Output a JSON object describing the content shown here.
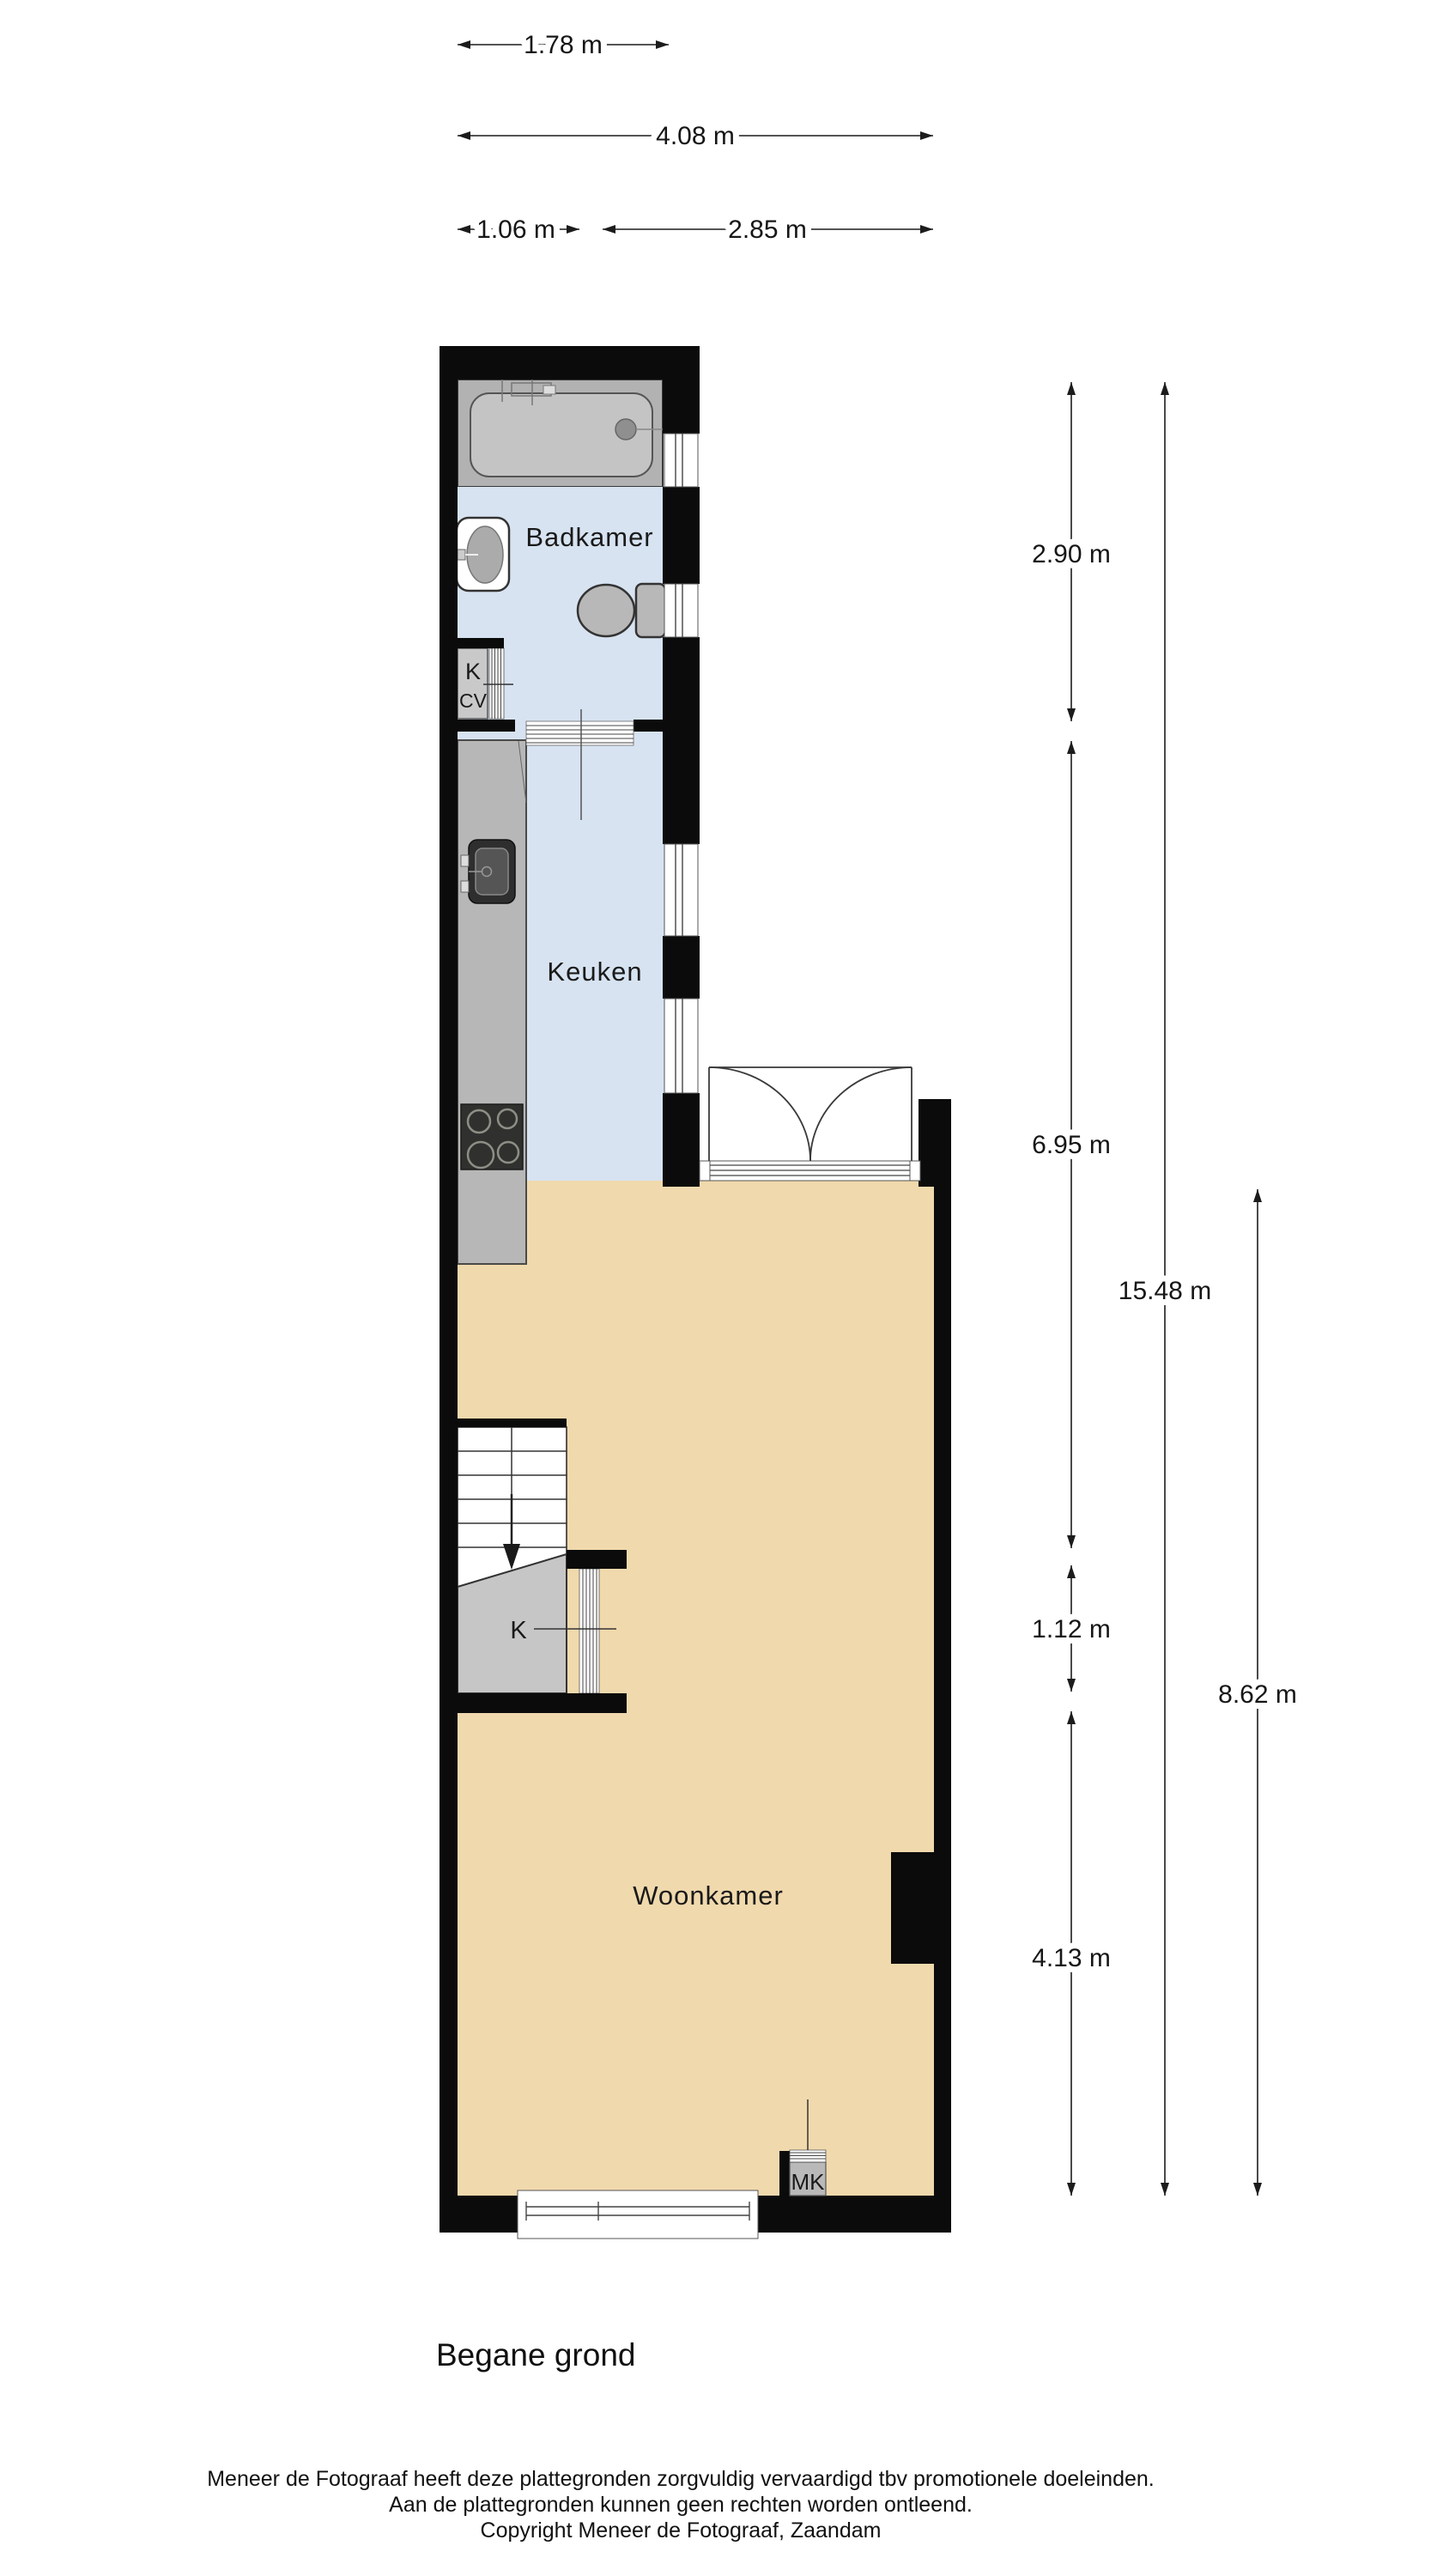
{
  "title": "Begane grond",
  "colors": {
    "wall": "#0b0b0b",
    "floor_bathroom_kitchen": "#d7e3f1",
    "floor_living": "#f0d9ad",
    "fixture_gray": "#b7b7b7"
  },
  "rooms": {
    "bathroom": {
      "label": "Badkamer"
    },
    "kitchen": {
      "label": "Keuken"
    },
    "living": {
      "label": "Woonkamer"
    }
  },
  "closets": {
    "boiler_top_label": "K",
    "boiler_bottom_label": "CV",
    "understairs_label": "K",
    "meter_label": "MK"
  },
  "dimensions": {
    "top": [
      {
        "label": "1.78 m",
        "value_m": 1.78
      },
      {
        "label": "4.08 m",
        "value_m": 4.08
      },
      {
        "label": "1.06 m",
        "value_m": 1.06
      },
      {
        "label": "2.85 m",
        "value_m": 2.85
      }
    ],
    "right": [
      {
        "label": "2.90 m",
        "value_m": 2.9
      },
      {
        "label": "6.95 m",
        "value_m": 6.95
      },
      {
        "label": "1.12 m",
        "value_m": 1.12
      },
      {
        "label": "4.13 m",
        "value_m": 4.13
      },
      {
        "label": "15.48 m",
        "value_m": 15.48
      },
      {
        "label": "8.62 m",
        "value_m": 8.62
      }
    ]
  },
  "footer": {
    "lines": [
      "Meneer de Fotograaf heeft deze plattegronden zorgvuldig vervaardigd tbv promotionele doeleinden.",
      "Aan de plattegronden kunnen geen rechten worden ontleend.",
      "Copyright Meneer de Fotograaf, Zaandam"
    ]
  }
}
